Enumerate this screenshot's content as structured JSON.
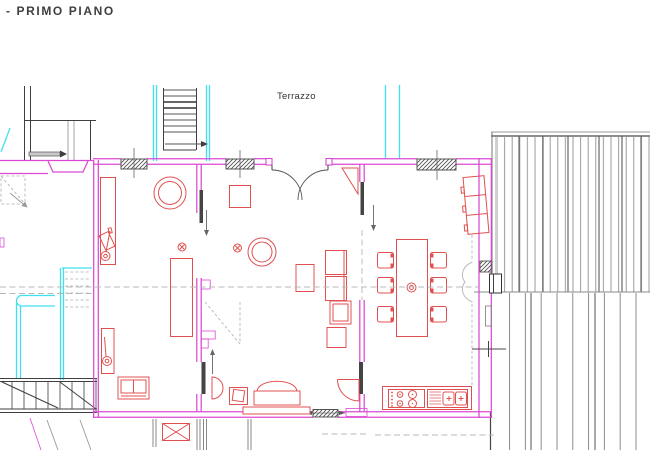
{
  "texts": {
    "floor_title": "- PRIMO PIANO",
    "terrace": "Terrazzo"
  },
  "colors": {
    "wall": "#db49d4",
    "furniture": "#e05050",
    "glass": "#3fe0ef",
    "structure": "#3f3f3f",
    "hatch": "#8f8f8f",
    "dash": "#b8b8b8",
    "paper": "#ffffff"
  }
}
